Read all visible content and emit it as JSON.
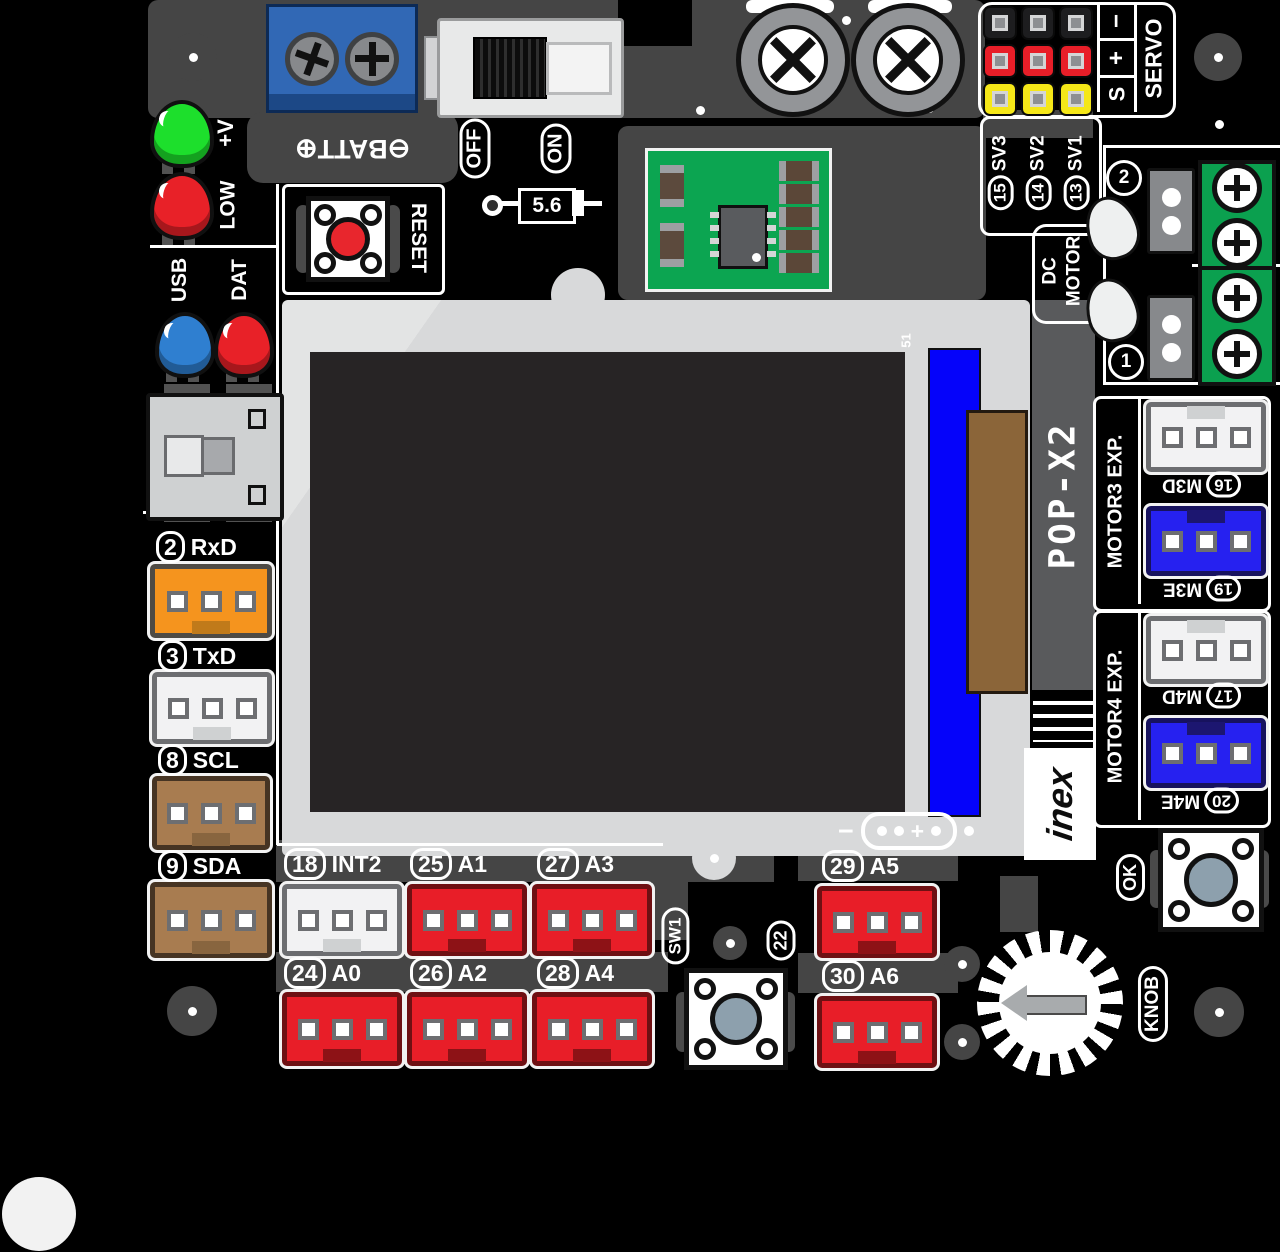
{
  "board": {
    "model": "POP-X2",
    "brand": "inex",
    "ref": "51"
  },
  "top": {
    "batt": "⊖BATT⊕",
    "off": "OFF",
    "on": "ON",
    "zener": "5.6",
    "reset": "RESET"
  },
  "status_leds": {
    "vplus": "+V",
    "low": "LOW",
    "usb": "USB",
    "dat": "DAT"
  },
  "servo": {
    "title": "SERVO",
    "sig": "S",
    "plus": "+",
    "minus": "−",
    "ch": [
      {
        "n": "15",
        "l": "SV3"
      },
      {
        "n": "14",
        "l": "SV2"
      },
      {
        "n": "13",
        "l": "SV1"
      }
    ]
  },
  "dcmotor": {
    "l1": "DC",
    "l2": "MOTOR",
    "ch2": "2",
    "ch1": "1"
  },
  "motor3": {
    "title": "MOTOR3 EXP.",
    "d_n": "16",
    "d_l": "M3D",
    "e_n": "19",
    "e_l": "M3E"
  },
  "motor4": {
    "title": "MOTOR4 EXP.",
    "d_n": "17",
    "d_l": "M4D",
    "e_n": "20",
    "e_l": "M4E"
  },
  "left_ports": [
    {
      "n": "2",
      "l": "RxD"
    },
    {
      "n": "3",
      "l": "TxD"
    },
    {
      "n": "8",
      "l": "SCL"
    },
    {
      "n": "9",
      "l": "SDA"
    }
  ],
  "bottom_row1": [
    {
      "n": "18",
      "l": "INT2"
    },
    {
      "n": "25",
      "l": "A1"
    },
    {
      "n": "27",
      "l": "A3"
    },
    {
      "n": "29",
      "l": "A5"
    }
  ],
  "bottom_row2": [
    {
      "n": "24",
      "l": "A0"
    },
    {
      "n": "26",
      "l": "A2"
    },
    {
      "n": "28",
      "l": "A4"
    },
    {
      "n": "30",
      "l": "A6"
    }
  ],
  "controls": {
    "sw1": "SW1",
    "sw1_pin": "22",
    "ok": "OK",
    "knob": "KNOB"
  },
  "screen": {
    "minus": "−",
    "plus": "+"
  },
  "colors": {
    "board": "#000000",
    "trace": "#454545",
    "bezel": "#d8d9da",
    "screen": "#272425",
    "lcd_tab_blue": "#0503fa",
    "lcd_tab_brown": "#8b6539",
    "red_port": "#e81e28",
    "orange_port": "#f5941e",
    "brown_port": "#a87c50",
    "white_port": "#f2f2f3",
    "blue_port": "#2621f0",
    "green_terminal": "#0ba04f",
    "module_green": "#0ca551",
    "servo_black": "#1d1d1f",
    "servo_red": "#e81e28",
    "servo_yellow": "#f5e718",
    "led_green": "#1ddf2c",
    "led_red": "#e82128",
    "led_blue": "#2f7fd0",
    "battery_terminal": "#3168b5",
    "reset_red": "#e8262d"
  }
}
